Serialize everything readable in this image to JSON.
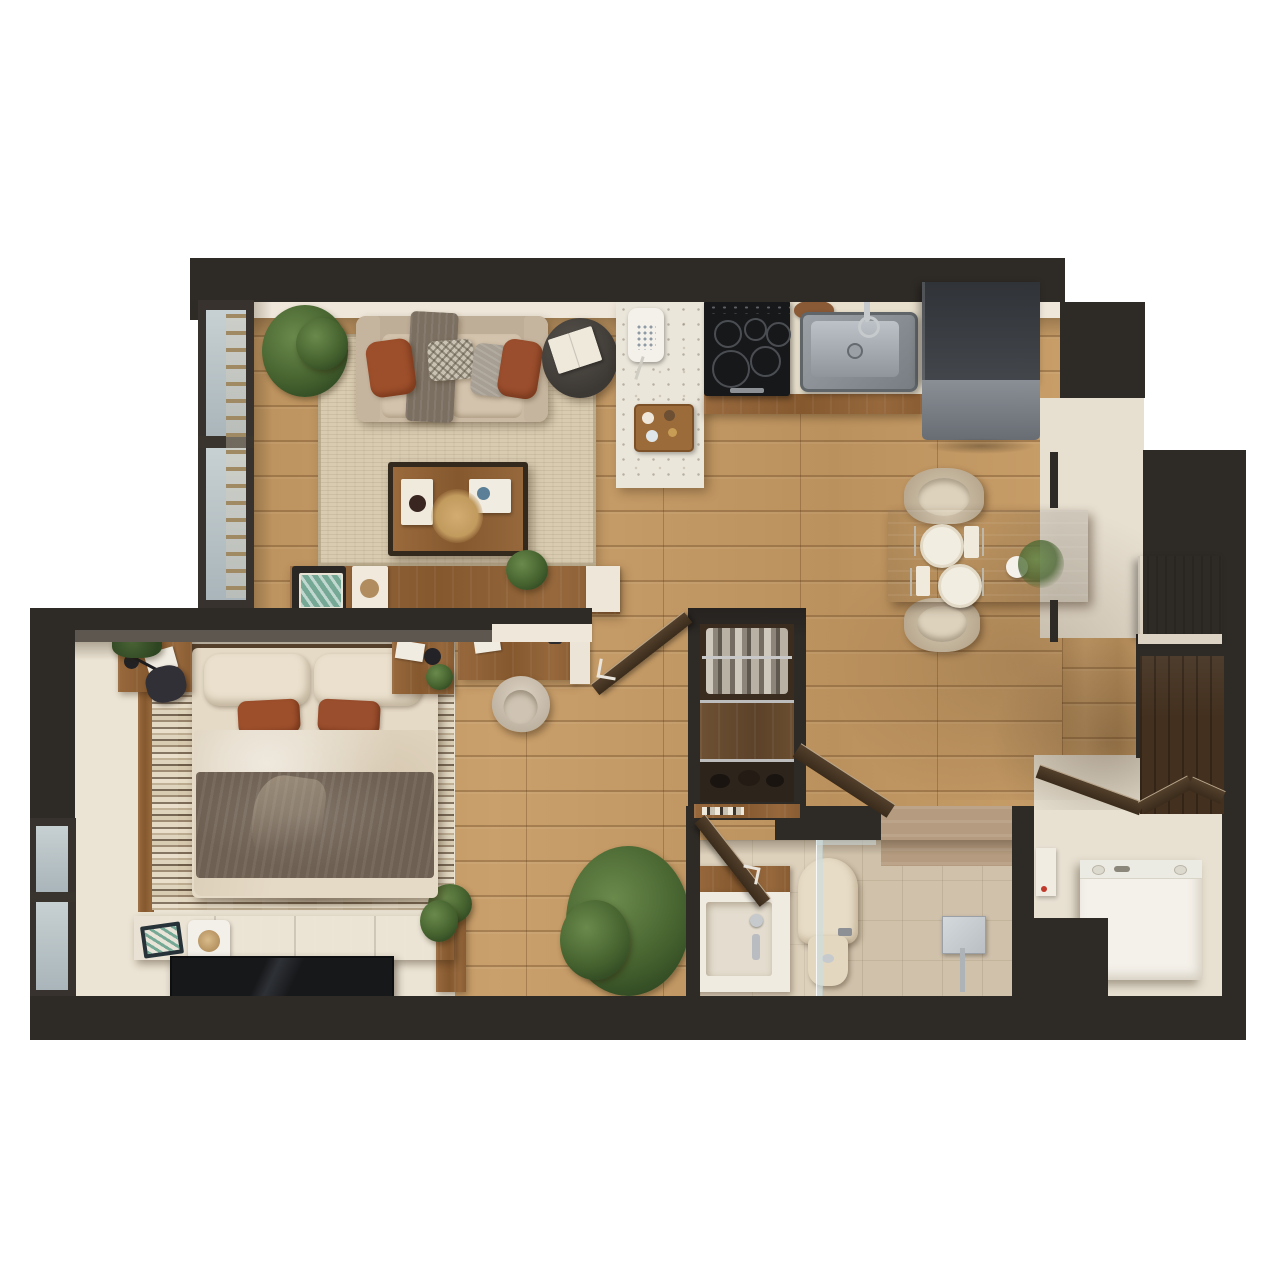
{
  "scene": {
    "type": "3d-floorplan-top-view",
    "description": "Top-down 3D render of a one-bedroom apartment floor plan on a white background",
    "canvas": {
      "width": 1280,
      "height": 1280
    },
    "visible_text": []
  },
  "palette": {
    "wall": "#2e2a26",
    "wallShade": "#211d1a",
    "wallFace": "#efe7d9",
    "wallTopFace": "#8a837c",
    "floorWood": "#c69a63",
    "rugLiving": "#d8cbb0",
    "bedroomFloor": "#ebe3d3",
    "bathFloor": "#ddd1bc",
    "tileShower": "#b59c80",
    "cream": "#e7dfd0",
    "terrazzo": "#ebe6da",
    "furnWood": "#8f6136",
    "furnWoodDark": "#6d4b2a",
    "darkWood": "#43301f",
    "doorWood": "#473627",
    "sofa": "#cbbaa3",
    "pillowRust": "#9d4f2b",
    "pillowGray": "#a79f93",
    "throwGray": "#7b6f61",
    "bedLinen": "#e5dac6",
    "bedThrow": "#6e6052",
    "black": "#1b1b1d",
    "stainless": "#a8adb2",
    "fridgeBody": "#3e4145",
    "fridgeDoor": "#7d8289",
    "glass": "#b9c4c7",
    "chrome": "#c6cacc",
    "white": "#f4f1ea",
    "plantGreen": "#4e6b38",
    "potBrown": "#6b4a33",
    "teal": "#76a896",
    "toiletBeige": "#e7dcc6"
  },
  "rooms": [
    {
      "id": "living-room",
      "label": "Living Room",
      "furniture": [
        "sofa with throw blanket",
        "rust accent pillows",
        "patterned pillow",
        "gray pillow",
        "round side table with book",
        "wood coffee table",
        "book stack",
        "decor tray",
        "dried pampas",
        "jute area rug",
        "corner potted plant",
        "media console with tray table, tray and plant",
        "floor-to-ceiling window wall with blinds"
      ]
    },
    {
      "id": "kitchen",
      "label": "Kitchen",
      "furniture": [
        "terrazzo island",
        "wall phone",
        "serving tray with cups",
        "black cooktop with five burners",
        "stainless sink with faucet",
        "cutting board",
        "cream counter",
        "wood cabinet edge",
        "refrigerator"
      ]
    },
    {
      "id": "dining-nook",
      "label": "Dining Nook",
      "furniture": [
        "wood dining table",
        "two place settings with plates, napkins and cutlery",
        "centerpiece plant in white pot",
        "two upholstered swivel chairs"
      ]
    },
    {
      "id": "hallway",
      "label": "Hallway",
      "furniture": [
        "built-in desk with chair and wall shelf",
        "open entry door",
        "open wardrobe with hanging clothes, shelf and shoes",
        "book shelf",
        "large floor plant",
        "wood plant stand"
      ]
    },
    {
      "id": "bedroom",
      "label": "Bedroom",
      "furniture": [
        "double bed",
        "two beige pillows",
        "two rust accent pillows",
        "duvet",
        "brown throw",
        "striped area rug",
        "vanity desk with papers, lamp and black chair",
        "hanging plant",
        "nightstand with lamp and plant",
        "low dresser with art tray, speaker and plant",
        "flat tv panel",
        "left window"
      ]
    },
    {
      "id": "bathroom",
      "label": "Bathroom",
      "furniture": [
        "wood vanity with white basin and faucet",
        "toilet",
        "glass shower partition",
        "walk-in shower with chrome fixture",
        "open door"
      ]
    },
    {
      "id": "utility",
      "label": "Utility / Laundry",
      "furniture": [
        "washing machine",
        "bi-fold accordion closet doors",
        "built-in wood cabinet",
        "dark wardrobe niche",
        "small wall fixture"
      ]
    }
  ]
}
